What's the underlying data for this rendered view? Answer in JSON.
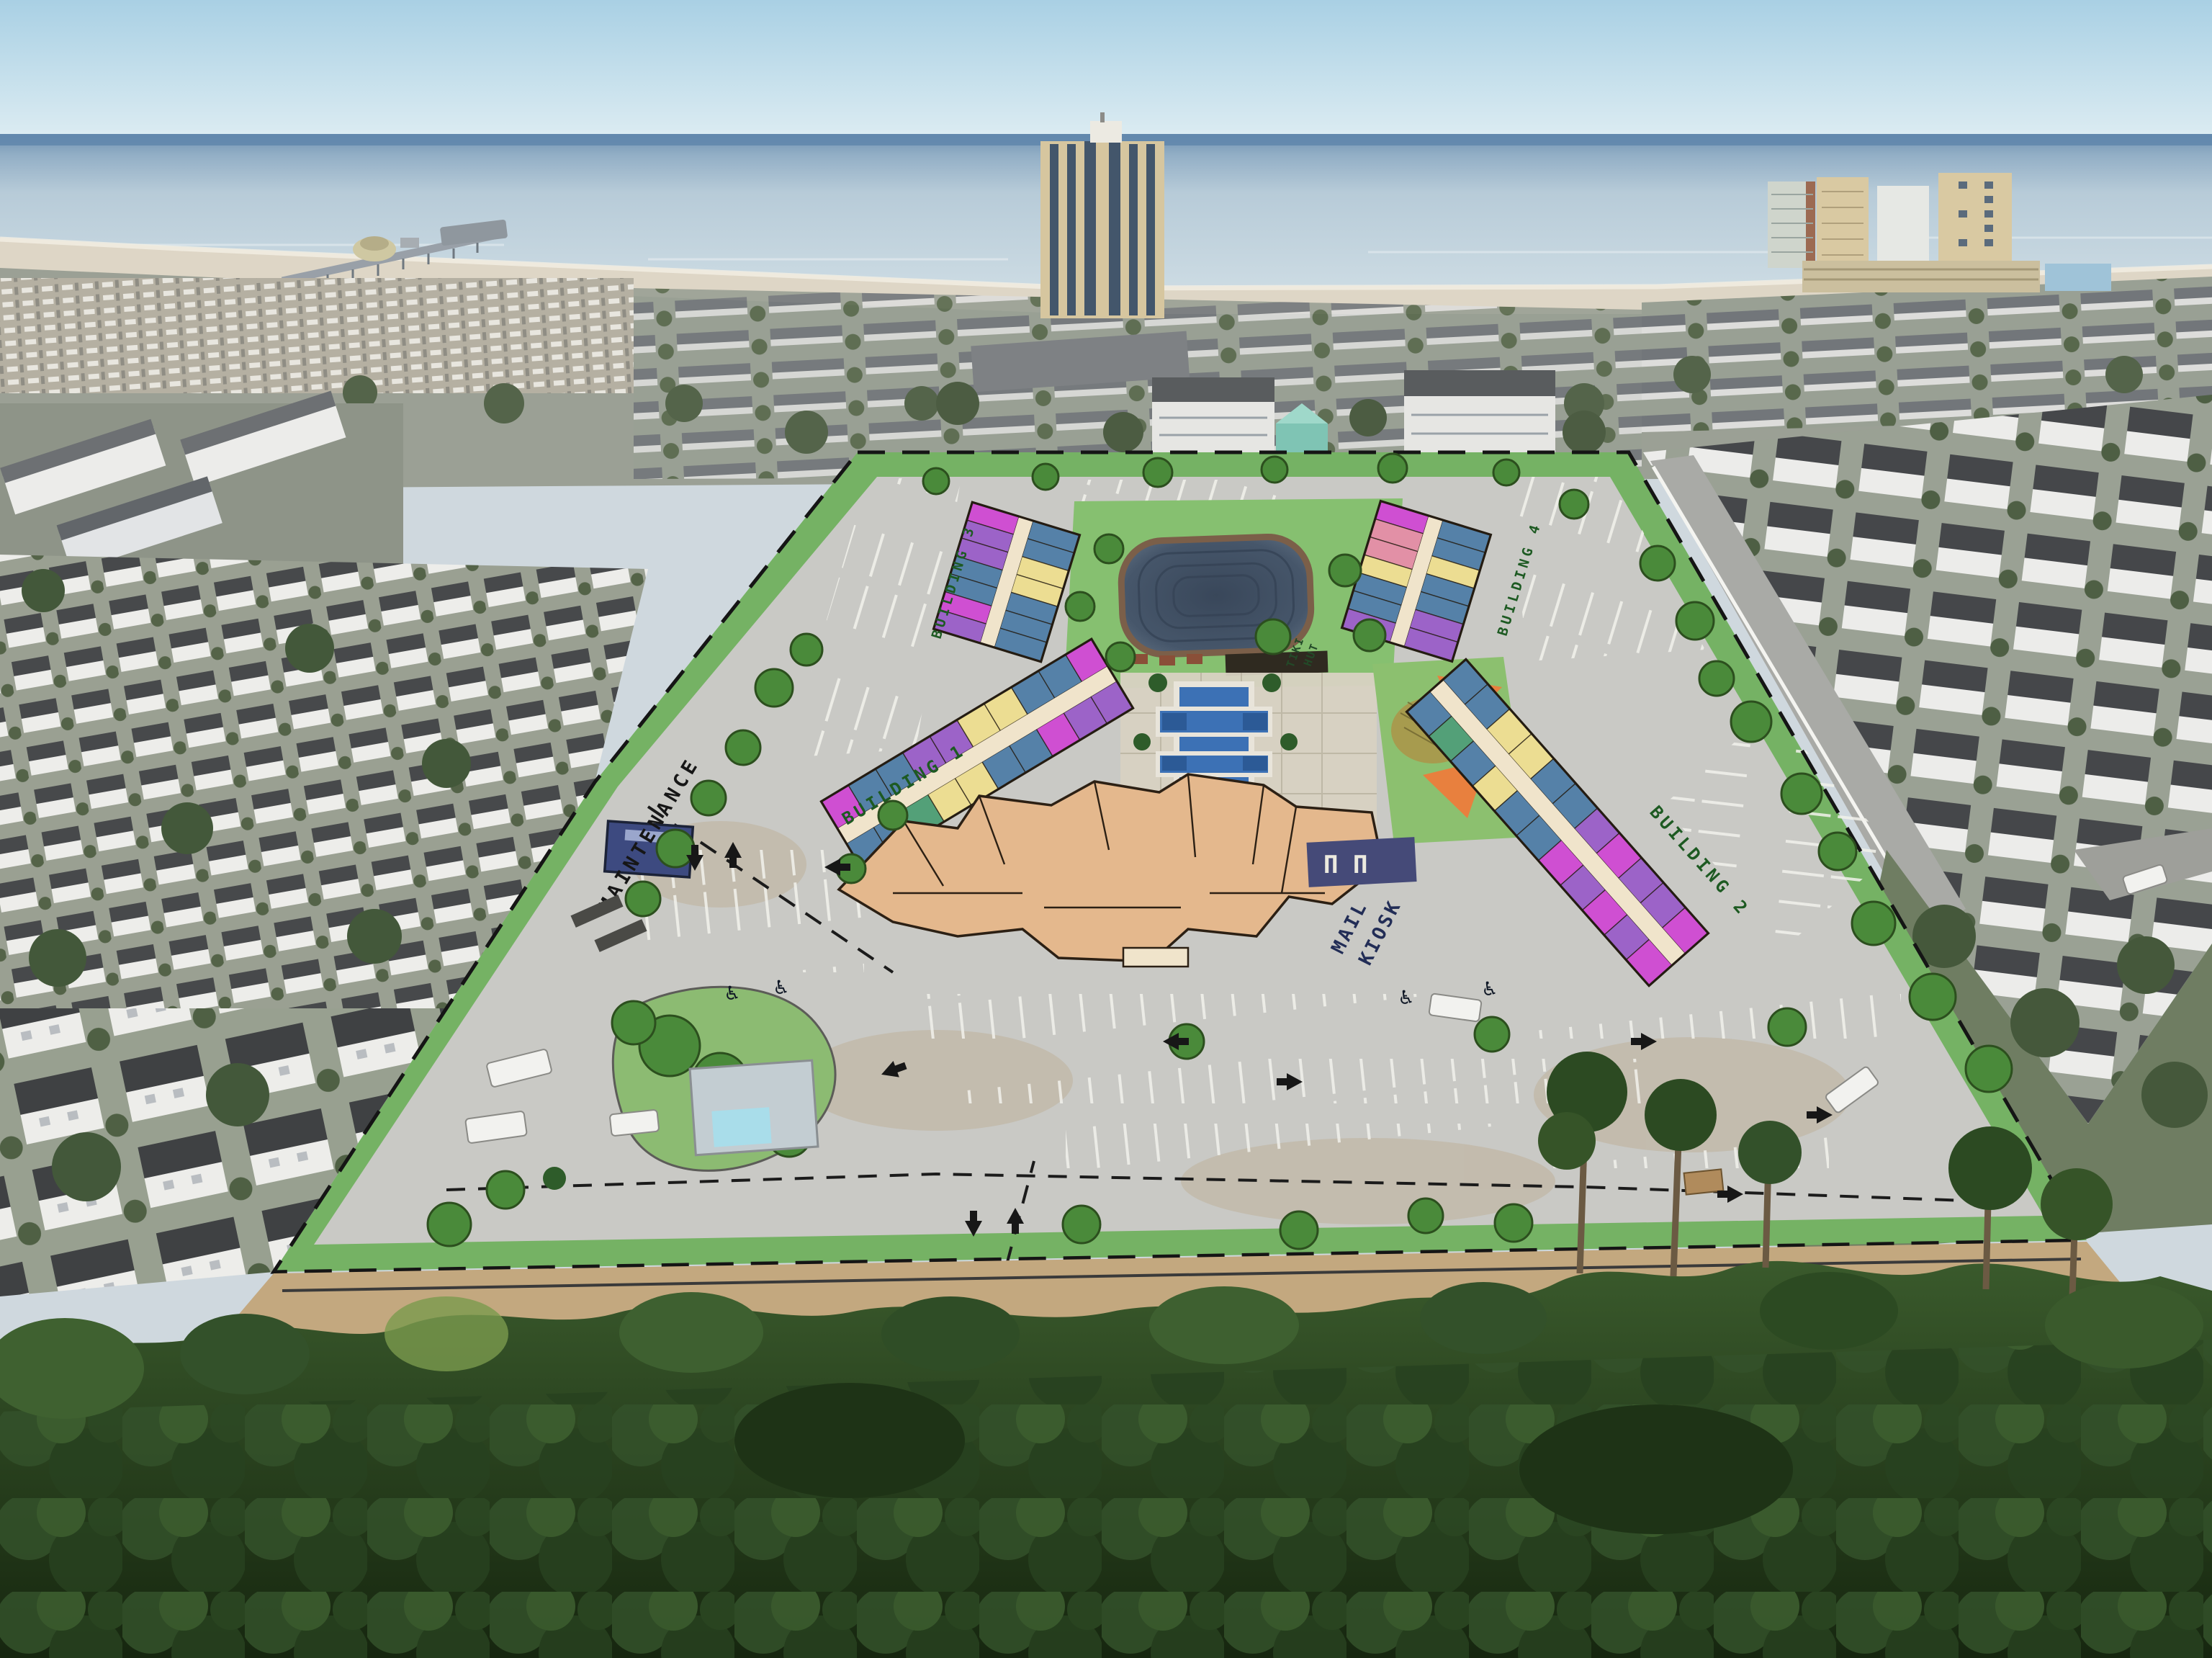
{
  "site_plan": {
    "labels": {
      "maintenance": "MAINTENANCE",
      "building_1": "BUILDING 1",
      "building_2": "BUILDING 2",
      "building_3": "BUILDING 3",
      "building_4": "BUILDING 4",
      "mail_line1": "MAIL",
      "mail_line2": "KIOSK",
      "tiki_line1": "TIKI",
      "tiki_line2": "HUT",
      "pergola_glyphs": "Π Π",
      "handicap_symbol": "♿"
    },
    "colors": {
      "overlay_green": "#7cb86a",
      "parking_gray": "#c9c9c5",
      "unit_blue": "#5581a8",
      "unit_purple": "#9c63c8",
      "unit_magenta": "#cf4fd2",
      "unit_yellow": "#ecdd92",
      "unit_pink": "#e290a6",
      "unit_green": "#53a078",
      "corridor_cream": "#f0e4cb",
      "clubhouse_tan": "#e4b88d",
      "pool_blue": "#3c71b5",
      "pond_slate": "#45556a",
      "maintenance_navy": "#3d4a80",
      "shade_sail_orange": "#e8803e",
      "label_green": "#1d5a22",
      "label_navy": "#222d56",
      "label_black": "#161616"
    }
  },
  "background": {
    "colors": {
      "sky": "#b4d7e7",
      "horizon_band": "#6f92b2",
      "ocean": "#b9cedd",
      "beach_sand": "#ded6c6",
      "roof_dark": "#4a4d4f",
      "house_white": "#ededea",
      "tower_tan": "#d6c69f",
      "forest_dark": "#223a1b"
    }
  }
}
